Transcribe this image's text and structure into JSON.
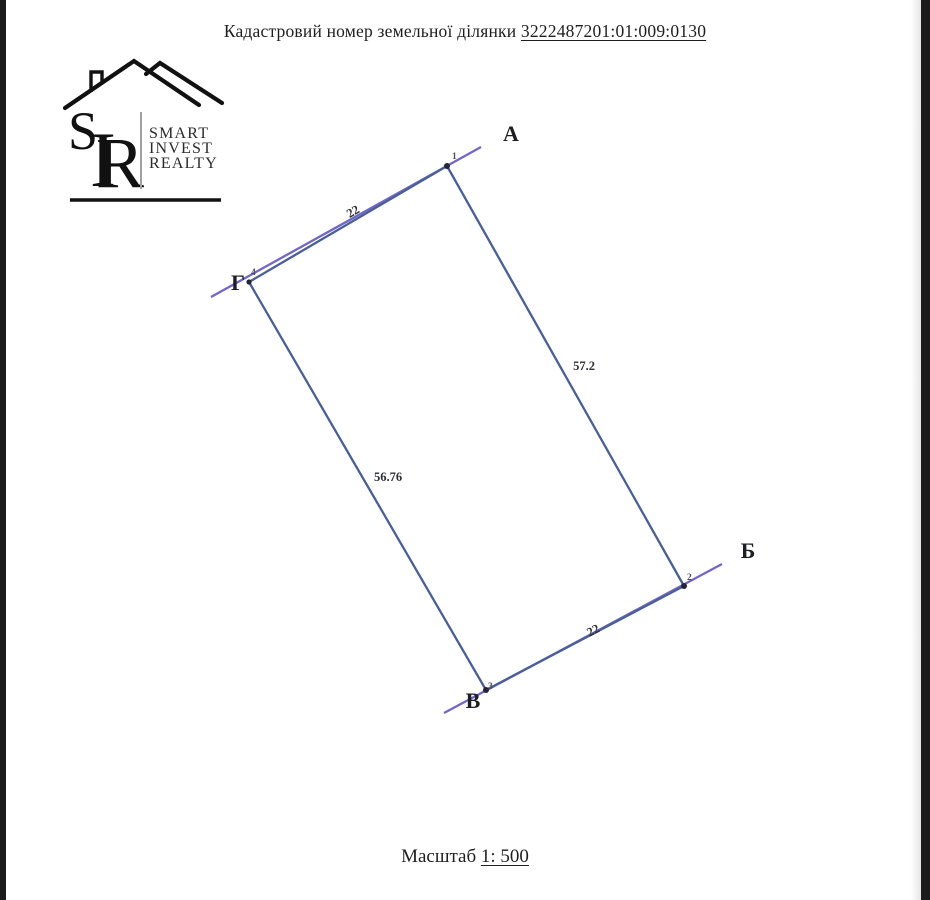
{
  "page": {
    "title_prefix": "Кадастровий номер земельної ділянки",
    "cadastral_number": "3222487201:01:009:0130",
    "scale_label": "Масштаб",
    "scale_value": "1: 500"
  },
  "logo": {
    "monogram": {
      "s": "S",
      "i": "I",
      "r": "R"
    },
    "word1": "SMART",
    "word2": "INVEST",
    "word3": "REALTY"
  },
  "parcel": {
    "corners": [
      {
        "label": "А",
        "point_number": "1"
      },
      {
        "label": "Б",
        "point_number": "2"
      },
      {
        "label": "В",
        "point_number": "3"
      },
      {
        "label": "Г",
        "point_number": "4"
      }
    ],
    "sides": [
      {
        "from": "Г",
        "to": "А",
        "value": "22"
      },
      {
        "from": "А",
        "to": "Б",
        "value": "57.2"
      },
      {
        "from": "В",
        "to": "Б",
        "value": "22"
      },
      {
        "from": "Г",
        "to": "В",
        "value": "56.76"
      }
    ],
    "colors": {
      "edge": "#4a5f93",
      "extension": "#7267c4",
      "vertex_dot": "#23233a"
    }
  }
}
